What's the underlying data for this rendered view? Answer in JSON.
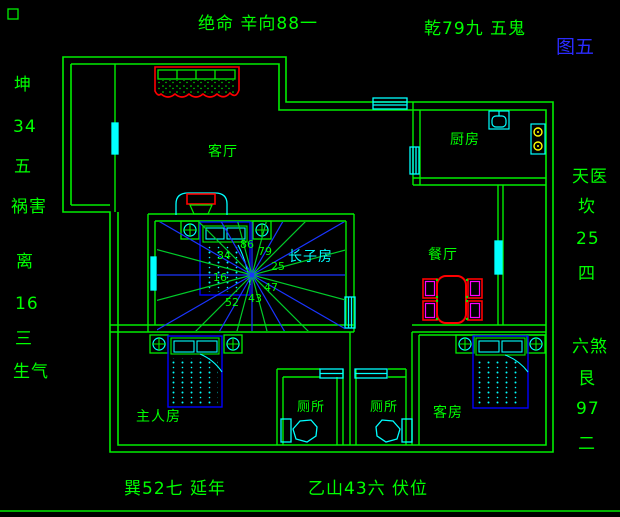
{
  "figure": {
    "label": "图五"
  },
  "compass_annotations": {
    "top_left": "绝命 辛向88一",
    "top_right": "乾79九 五鬼",
    "bottom_left": "巽52七 延年",
    "bottom_right": "乙山43六 伏位",
    "left": [
      "坤",
      "34",
      "五",
      "祸害",
      "离",
      "16",
      "三",
      "生气"
    ],
    "right": [
      "天医",
      "坎",
      "25",
      "四",
      "六煞",
      "艮",
      "97",
      "二"
    ]
  },
  "rooms": {
    "living": "客厅",
    "kitchen": "厨房",
    "dining": "餐厅",
    "eldest_son": "长子房",
    "master": "主人房",
    "toilet1": "厕所",
    "toilet2": "厕所",
    "guest": "客房"
  },
  "star_numbers": [
    "34",
    "86",
    "79",
    "25",
    "47",
    "43",
    "52",
    "16"
  ],
  "colors": {
    "background": "#000000",
    "wall": "#00ff00",
    "window": "#00ffff",
    "accent_red": "#ff0000",
    "accent_magenta": "#ff00ff",
    "accent_blue": "#0000ff",
    "ray_blue": "#1a35ff",
    "ray_green": "#00cc2a",
    "stove_burner": "#ffff00",
    "figure_label_blue": "#2b2bff"
  }
}
